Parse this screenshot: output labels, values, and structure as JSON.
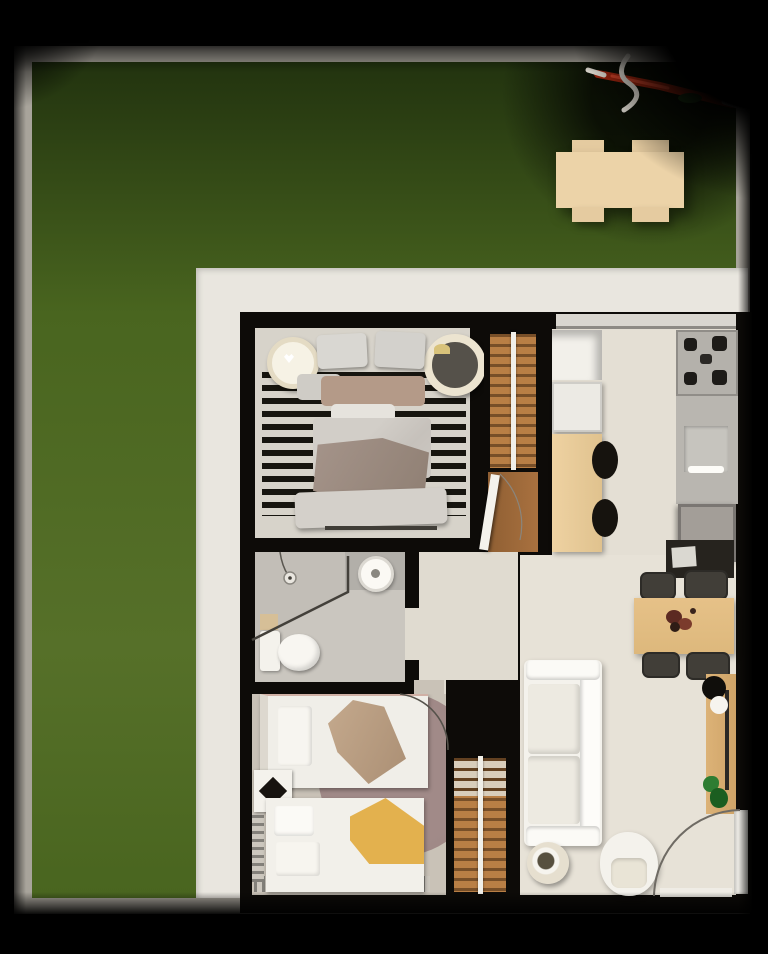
{
  "scene": {
    "type": "3d-floorplan-top-down-render",
    "description": "Photorealistic top-down 3D floor plan of an apartment with surrounding green lawn, white patio border and gray property wall",
    "yard": {
      "lawn": "green-grass",
      "boundary": "gray-wall-frame",
      "picnic_table": {
        "material": "light-wood",
        "seats": 4
      },
      "debris": "red-twig-with-white-ribbon-top-right"
    },
    "house": {
      "rooms": [
        {
          "name": "master-bedroom",
          "furniture": [
            "double-bed",
            "striped-rug",
            "round-nightstand-left",
            "round-nightstand-right",
            "wall-console",
            "slatted-wardrobe",
            "entry-door"
          ]
        },
        {
          "name": "kitchen",
          "furniture": [
            "open-cabinet",
            "white-cabinet",
            "wood-island",
            "bar-stool",
            "bar-stool",
            "cooktop-4-burners",
            "counter-with-sink",
            "refrigerator",
            "window-band"
          ]
        },
        {
          "name": "bathroom",
          "furniture": [
            "shower-head",
            "glass-partition",
            "sink-counter",
            "round-basin",
            "toilet",
            "wood-mat"
          ]
        },
        {
          "name": "kids-bedroom",
          "furniture": [
            "single-bed-tan-throw",
            "single-bed-yellow-throw",
            "diamond-rug",
            "round-mauve-rug",
            "fringe-rug",
            "door-swing"
          ]
        },
        {
          "name": "hallway",
          "furniture": [
            "slatted-wardrobe"
          ]
        },
        {
          "name": "living-dining",
          "furniture": [
            "white-sofa",
            "round-side-table",
            "armchair",
            "dining-table",
            "dining-chair",
            "dining-chair",
            "dining-chair",
            "dining-chair",
            "tv-console",
            "sideboard",
            "decor-spheres",
            "potted-plant",
            "entry-door-swing"
          ]
        }
      ]
    }
  },
  "palette": {
    "bg": "#030303",
    "frame": "#a8a49b",
    "grassDark": "#22330f",
    "grass": "#49651f",
    "grassLight": "#567029",
    "patio": "#e9e6df",
    "wall": "#0d0b08",
    "picnicWood": "#ecd3a8",
    "picnicSeat": "#e5cba0",
    "floorBedroom1": "#d7d3ca",
    "floorKitchen": "#e4dfd4",
    "floorLiving": "#e7e2d7",
    "floorBath": "#cac6bf",
    "floorBedroom2": "#c9c2b7",
    "floorHall": "#e0dbd0",
    "wood": "#b97f45",
    "woodDark": "#8f5f33",
    "railWhite": "#f1efe8",
    "islandTan": "#eed2a2",
    "tableTan": "#e6c188",
    "sideboardTan": "#dcb277",
    "furnWhite": "#f4f2ec",
    "cushion": "#edeae1",
    "taupe": "#9b8a7d",
    "tanBand": "#b49a88",
    "blanketGray": "#cbc6c0",
    "mauve": "#9c8583",
    "yellow": "#e3b14e",
    "stoolBlack": "#16130e",
    "chairDark": "#413e38",
    "applianceGray": "#b4b1ab",
    "fridgeGray": "#a39e98",
    "burner": "#1d1b18",
    "plantGreen": "#2e7d32",
    "plantGreenDark": "#1b5e20",
    "twigRed": "#a3260f",
    "twigRedLight": "#d8452a",
    "ribbonWhite": "#e9e5db",
    "lineGray": "#6f6b64"
  }
}
